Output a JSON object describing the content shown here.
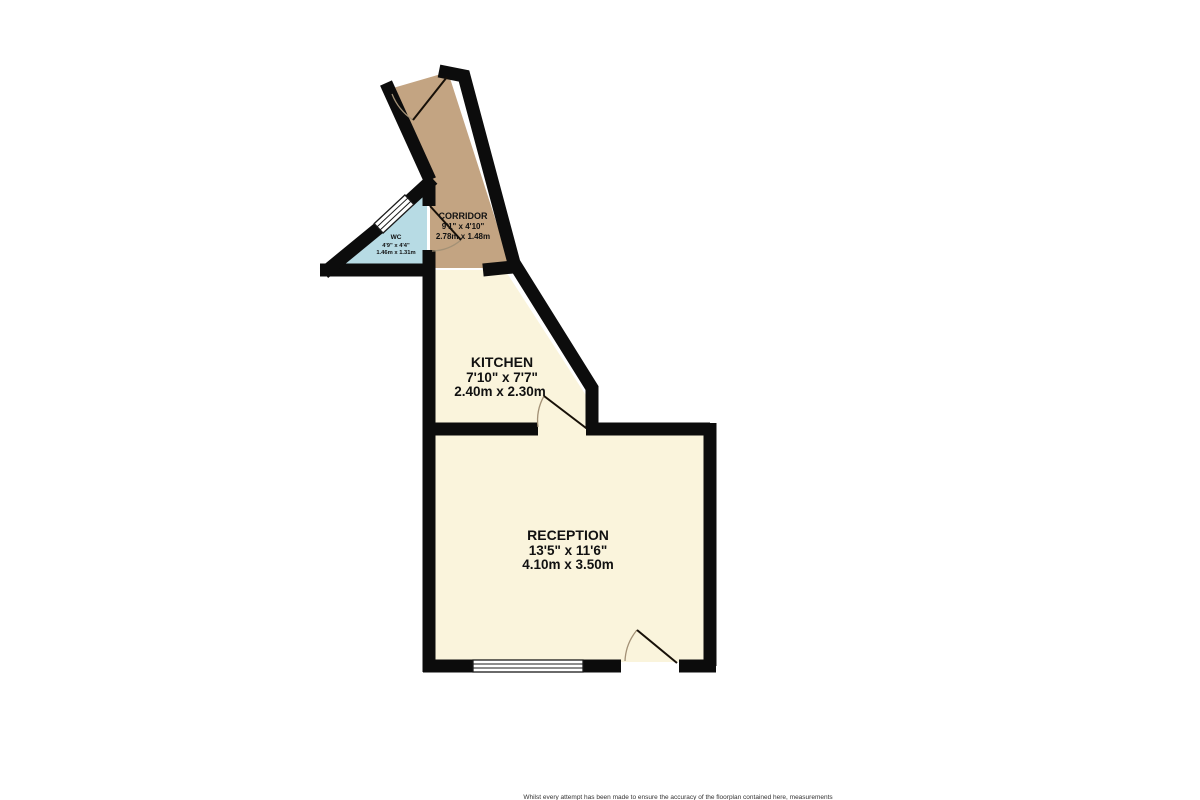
{
  "rooms": {
    "corridor": {
      "name": "CORRIDOR",
      "imperial": "9'1\" x 4'10\"",
      "metric": "2.78m x 1.48m"
    },
    "wc": {
      "name": "WC",
      "imperial": "4'9\" x 4'4\"",
      "metric": "1.46m x 1.31m"
    },
    "kitchen": {
      "name": "KITCHEN",
      "imperial": "7'10\" x 7'7\"",
      "metric": "2.40m x 2.30m"
    },
    "reception": {
      "name": "RECEPTION",
      "imperial": "13'5\" x 11'6\"",
      "metric": "4.10m x 3.50m"
    }
  },
  "disclaimer": "Whilst every attempt has been made to ensure the accuracy of the floorplan contained here, measurements",
  "colors": {
    "wall": "#0c0c0c",
    "corridor_fill": "#c3a482",
    "wc_fill": "#b7dbe4",
    "room_fill": "#faf4dc",
    "background": "#ffffff"
  }
}
